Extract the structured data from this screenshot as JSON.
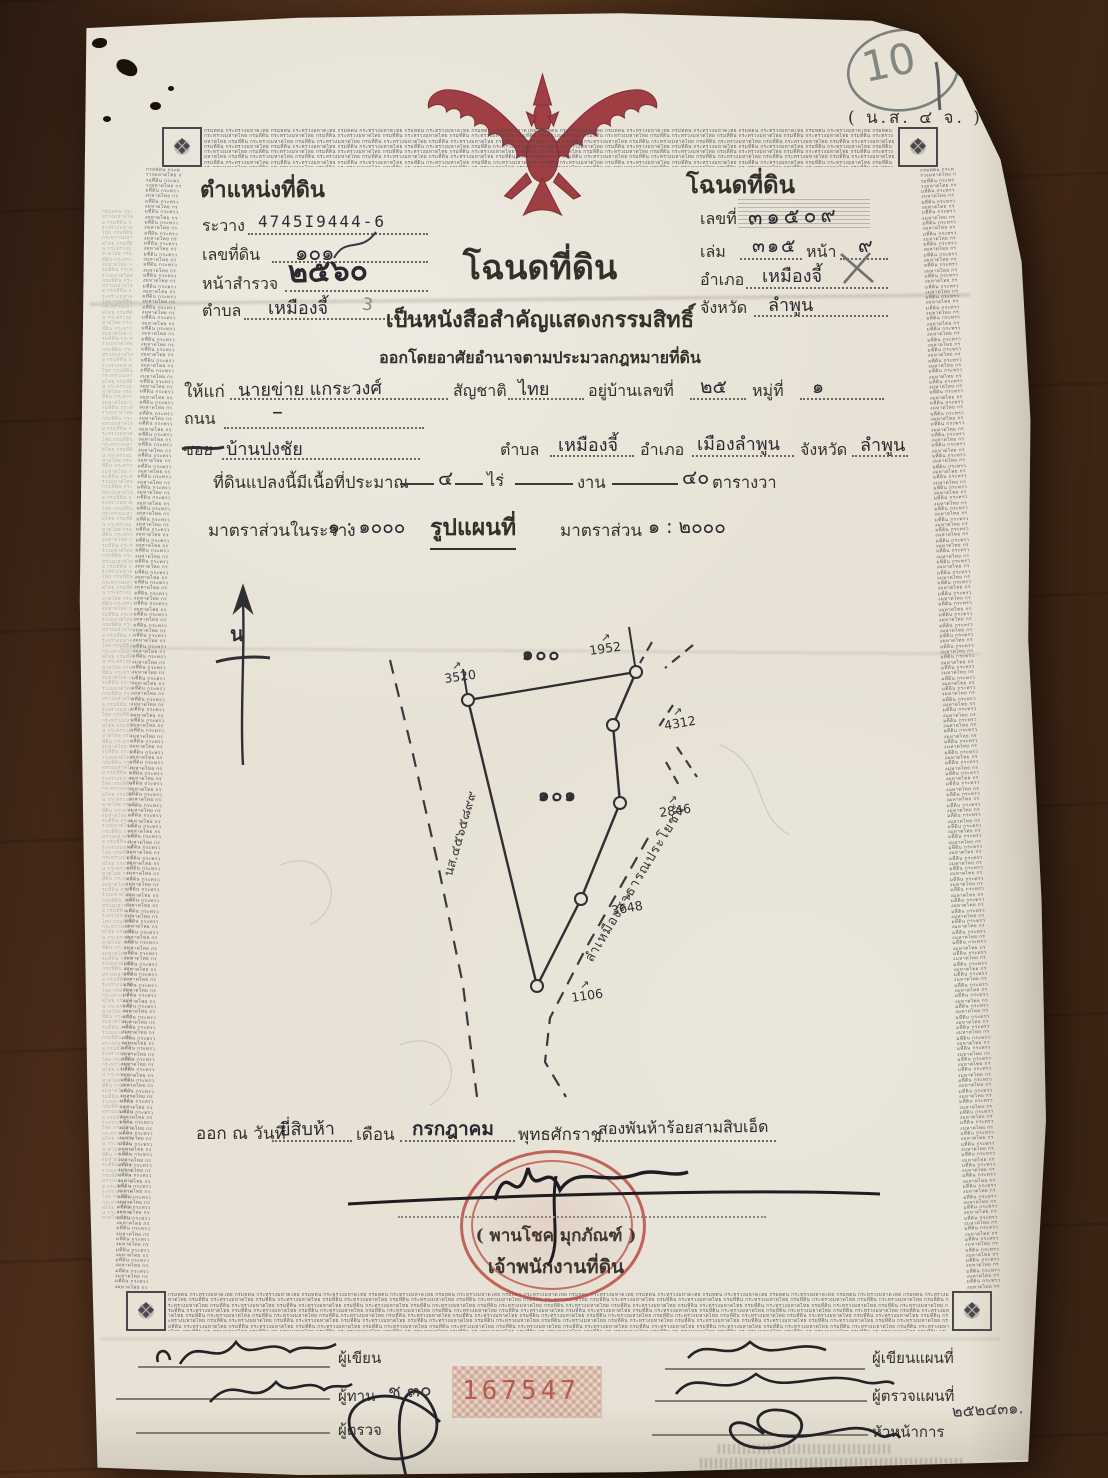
{
  "corner_note": {
    "number": "10",
    "form_code": "( น.ส. ๔ จ. )"
  },
  "border": {
    "microtext": "กรมที่ดิน กระทรวงมหาดไทย "
  },
  "position_block": {
    "title": "ตำแหน่งที่ดิน",
    "rawang_label": "ระวาง",
    "rawang_value": "4745I9444-6",
    "parcel_label": "เลขที่ดิน",
    "parcel_value": "๑๐๑",
    "survey_label": "หน้าสำรวจ",
    "survey_value": "๒๕๖๐",
    "tambon_label": "ตำบล",
    "tambon_value": "เหมืองจี้",
    "pencil_note": "3"
  },
  "deed_block": {
    "title": "โฉนดที่ดิน",
    "number_label": "เลขที่",
    "number_value": "๓๑๕๐๙",
    "volume_label": "เล่ม",
    "volume_value": "๓๑๕",
    "page_label": "หน้า",
    "page_value": "๙",
    "amphoe_label": "อำเภอ",
    "amphoe_value": "เหมืองจี้",
    "province_label": "จังหวัด",
    "province_value": "ลำพูน"
  },
  "heading": {
    "title": "โฉนดที่ดิน",
    "line2": "เป็นหนังสือสำคัญแสดงกรรมสิทธิ์",
    "line3": "ออกโดยอาศัยอำนาจตามประมวลกฎหมายที่ดิน"
  },
  "grant": {
    "to_label": "ให้แก่",
    "to_value": "นายข่าย  แกระวงศ์",
    "nationality_label": "สัญชาติ",
    "nationality_value": "ไทย",
    "house_label": "อยู่บ้านเลขที่",
    "house_value": "๒๕",
    "moo_label": "หมู่ที่",
    "moo_value": "๑",
    "road_label": "ถนน",
    "road_value": "–",
    "soi_label": "ซอย",
    "soi_value": "บ้านปงชัย",
    "tambon_label": "ตำบล",
    "tambon_value": "เหมืองจี้",
    "amphoe_label": "อำเภอ",
    "amphoe_value": "เมืองลำพูน",
    "province_label": "จังหวัด",
    "province_value": "ลำพูน"
  },
  "area_line": {
    "prefix": "ที่ดินแปลงนี้มีเนื้อที่ประมาณ",
    "rai_value": "๔",
    "rai_label": "ไร่",
    "ngan_label": "งาน",
    "wa_value": "๔๐",
    "wa_label": "ตารางวา"
  },
  "scale_line": {
    "left_label": "มาตราส่วนในระวาง",
    "left_value": "๑ : ๑๐๐๐",
    "center": "รูปแผนที่",
    "right_label": "มาตราส่วน",
    "right_value": "๑ : ๒๐๐๐"
  },
  "map": {
    "north": "น",
    "adjacent_parcel": "๑๐๐",
    "parcel": "๑๐๑",
    "arrow": "↗",
    "marker_tl": "3520",
    "marker_tr": "1952",
    "marker_r1": "4312",
    "marker_r2": "2846",
    "marker_r3": "3648",
    "marker_b": "1106",
    "left_annotation": "นส.๔๕๖๕๘๙๙",
    "canal_label": "ลำเหมืองสาธารณประโยชน์"
  },
  "issue_line": {
    "prefix": "ออก ณ วันที่",
    "day": "ยี่สิบห้า",
    "month_label": "เดือน",
    "month": "กรกฎาคม",
    "era_label": "พุทธศักราช",
    "year": "สองพันห้าร้อยสามสิบเอ็ด"
  },
  "seal": {
    "name": "( พานโชค  มุกภัณฑ์ )",
    "title": "เจ้าพนักงานที่ดิน"
  },
  "sign_left": {
    "writer": "ผู้เขียน",
    "checker": "ผู้ทาน",
    "inspector": "ผู้ตรวจ",
    "note": "ช ๓๐",
    "serial": "167547"
  },
  "sign_right": {
    "map_writer": "ผู้เขียนแผนที่",
    "map_inspector": "ผู้ตรวจแผนที่",
    "chief": "หัวหน้าการ",
    "note": "๒๕๒๔๓๑."
  }
}
